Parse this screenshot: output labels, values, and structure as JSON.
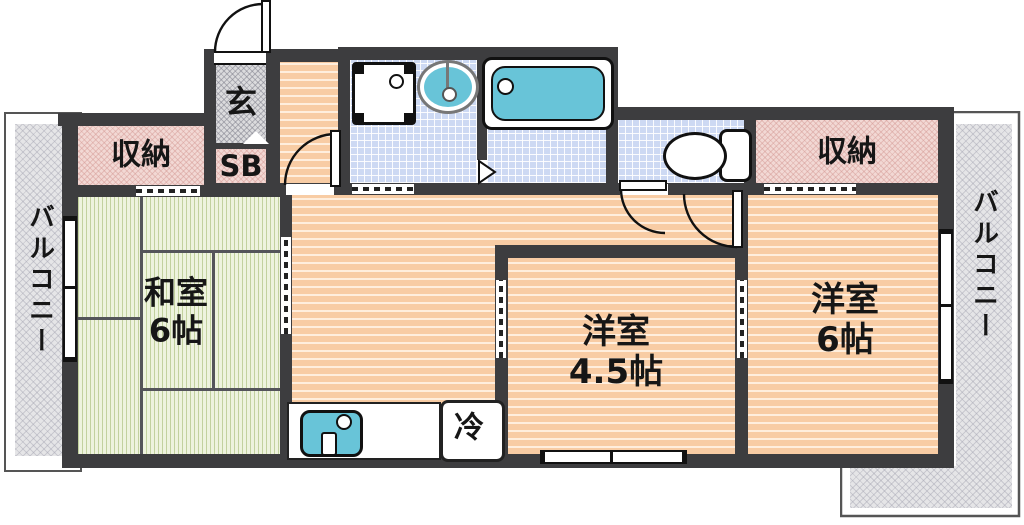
{
  "rooms": {
    "entrance": {
      "label": "玄"
    },
    "shoe_box": {
      "label": "SB"
    },
    "storage_left": {
      "label": "収納"
    },
    "storage_right": {
      "label": "収納"
    },
    "japanese_room": {
      "name": "和室",
      "size": "6帖"
    },
    "western_room_small": {
      "name": "洋室",
      "size": "4.5帖"
    },
    "western_room_large": {
      "name": "洋室",
      "size": "6帖"
    },
    "balcony_left": {
      "label": "バルコニー"
    },
    "balcony_right": {
      "label": "バルコニー"
    },
    "refrigerator": {
      "label": "冷"
    }
  },
  "colors": {
    "wall": "#3d3d3f",
    "flooring": "#f8cca4",
    "tatami": "#eef3de",
    "tile": "#cdd9f3",
    "closet_pink": "#f2d8d4",
    "balcony_gray": "#e5e5e7",
    "fixture_teal": "#68c4d8"
  }
}
